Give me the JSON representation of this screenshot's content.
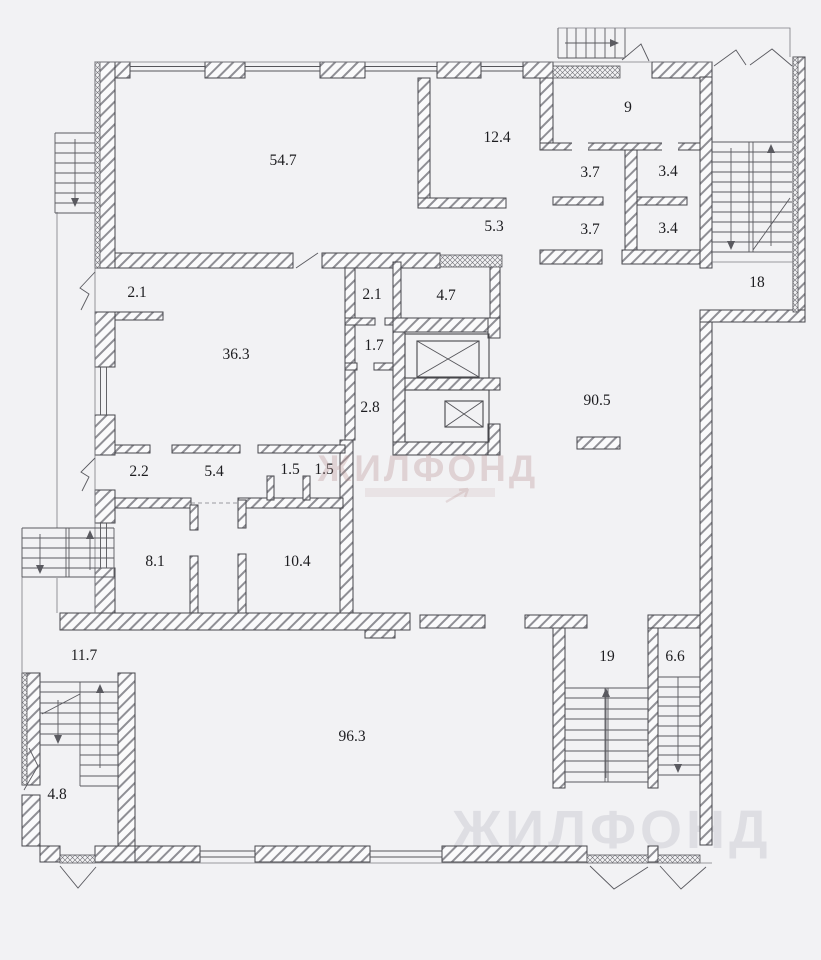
{
  "plan": {
    "background_color": "#f2f2f4",
    "line_color": "#46464b",
    "hatch_color": "#85858c",
    "watermark_pink": "#b68b8b",
    "watermark_gray": "#c9c9d0"
  },
  "watermarks": {
    "center_title": "ЖИЛФОНД",
    "bottom_text": "ЖИЛФОНД"
  },
  "rooms": [
    {
      "label": "54.7"
    },
    {
      "label": "12.4"
    },
    {
      "label": "9"
    },
    {
      "label": "3.7"
    },
    {
      "label": "3.4"
    },
    {
      "label": "5.3"
    },
    {
      "label": "3.7"
    },
    {
      "label": "3.4"
    },
    {
      "label": "18"
    },
    {
      "label": "2.1"
    },
    {
      "label": "2.1"
    },
    {
      "label": "4.7"
    },
    {
      "label": "36.3"
    },
    {
      "label": "1.7"
    },
    {
      "label": "2.8"
    },
    {
      "label": "90.5"
    },
    {
      "label": "2.2"
    },
    {
      "label": "5.4"
    },
    {
      "label": "1.5"
    },
    {
      "label": "1.5"
    },
    {
      "label": "8.1"
    },
    {
      "label": "10.4"
    },
    {
      "label": "11.7"
    },
    {
      "label": "19"
    },
    {
      "label": "6.6"
    },
    {
      "label": "96.3"
    },
    {
      "label": "4.8"
    }
  ]
}
